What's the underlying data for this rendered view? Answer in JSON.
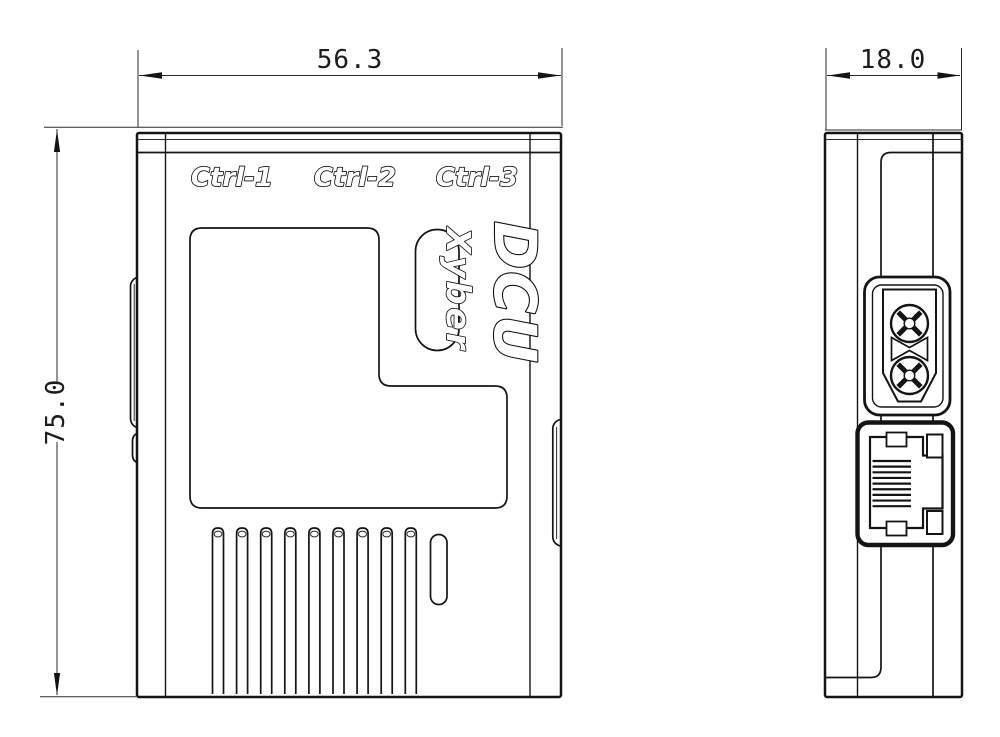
{
  "dimensions": {
    "front_width": "56.3",
    "front_height": "75.0",
    "side_depth": "18.0"
  },
  "front_view": {
    "port_labels": [
      "Ctrl-1",
      "Ctrl-2",
      "Ctrl-3"
    ],
    "product_name": "DCU",
    "brand": "Xyber",
    "vents": {
      "count": 9
    }
  },
  "side_view": {
    "connectors": [
      "power-connector",
      "ethernet-port"
    ],
    "ethernet_pins": {
      "count": 9
    }
  },
  "colors": {
    "line": "#141414",
    "background": "#ffffff"
  }
}
